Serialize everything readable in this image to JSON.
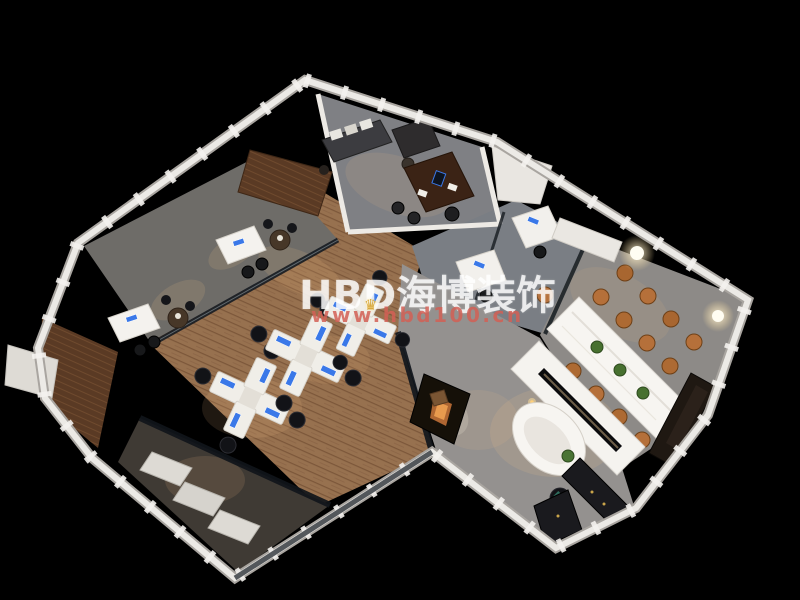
{
  "canvas": {
    "width": 800,
    "height": 600,
    "background": "#000000"
  },
  "watermark": {
    "brand_text": "HBD海博装饰",
    "url_text": "www.hbd100.cn",
    "brand_color": "#ffffff",
    "url_color": "#d25f55",
    "crown_color": "#d8a93e"
  },
  "palette": {
    "wood_floor": "#97714f",
    "concrete_floor": "#908e91",
    "carpet_floor": "#6e6c68",
    "wall_white": "#eceae6",
    "walnut_wood": "#5a3a24",
    "desk_white": "#f2f0ec",
    "screen_blue": "#3a78e8",
    "conference_chair_tan": "#b5703a",
    "dark_sofa": "#1a1a1e",
    "glass_dark": "#141a20",
    "warm_light": "#ffc98a"
  }
}
